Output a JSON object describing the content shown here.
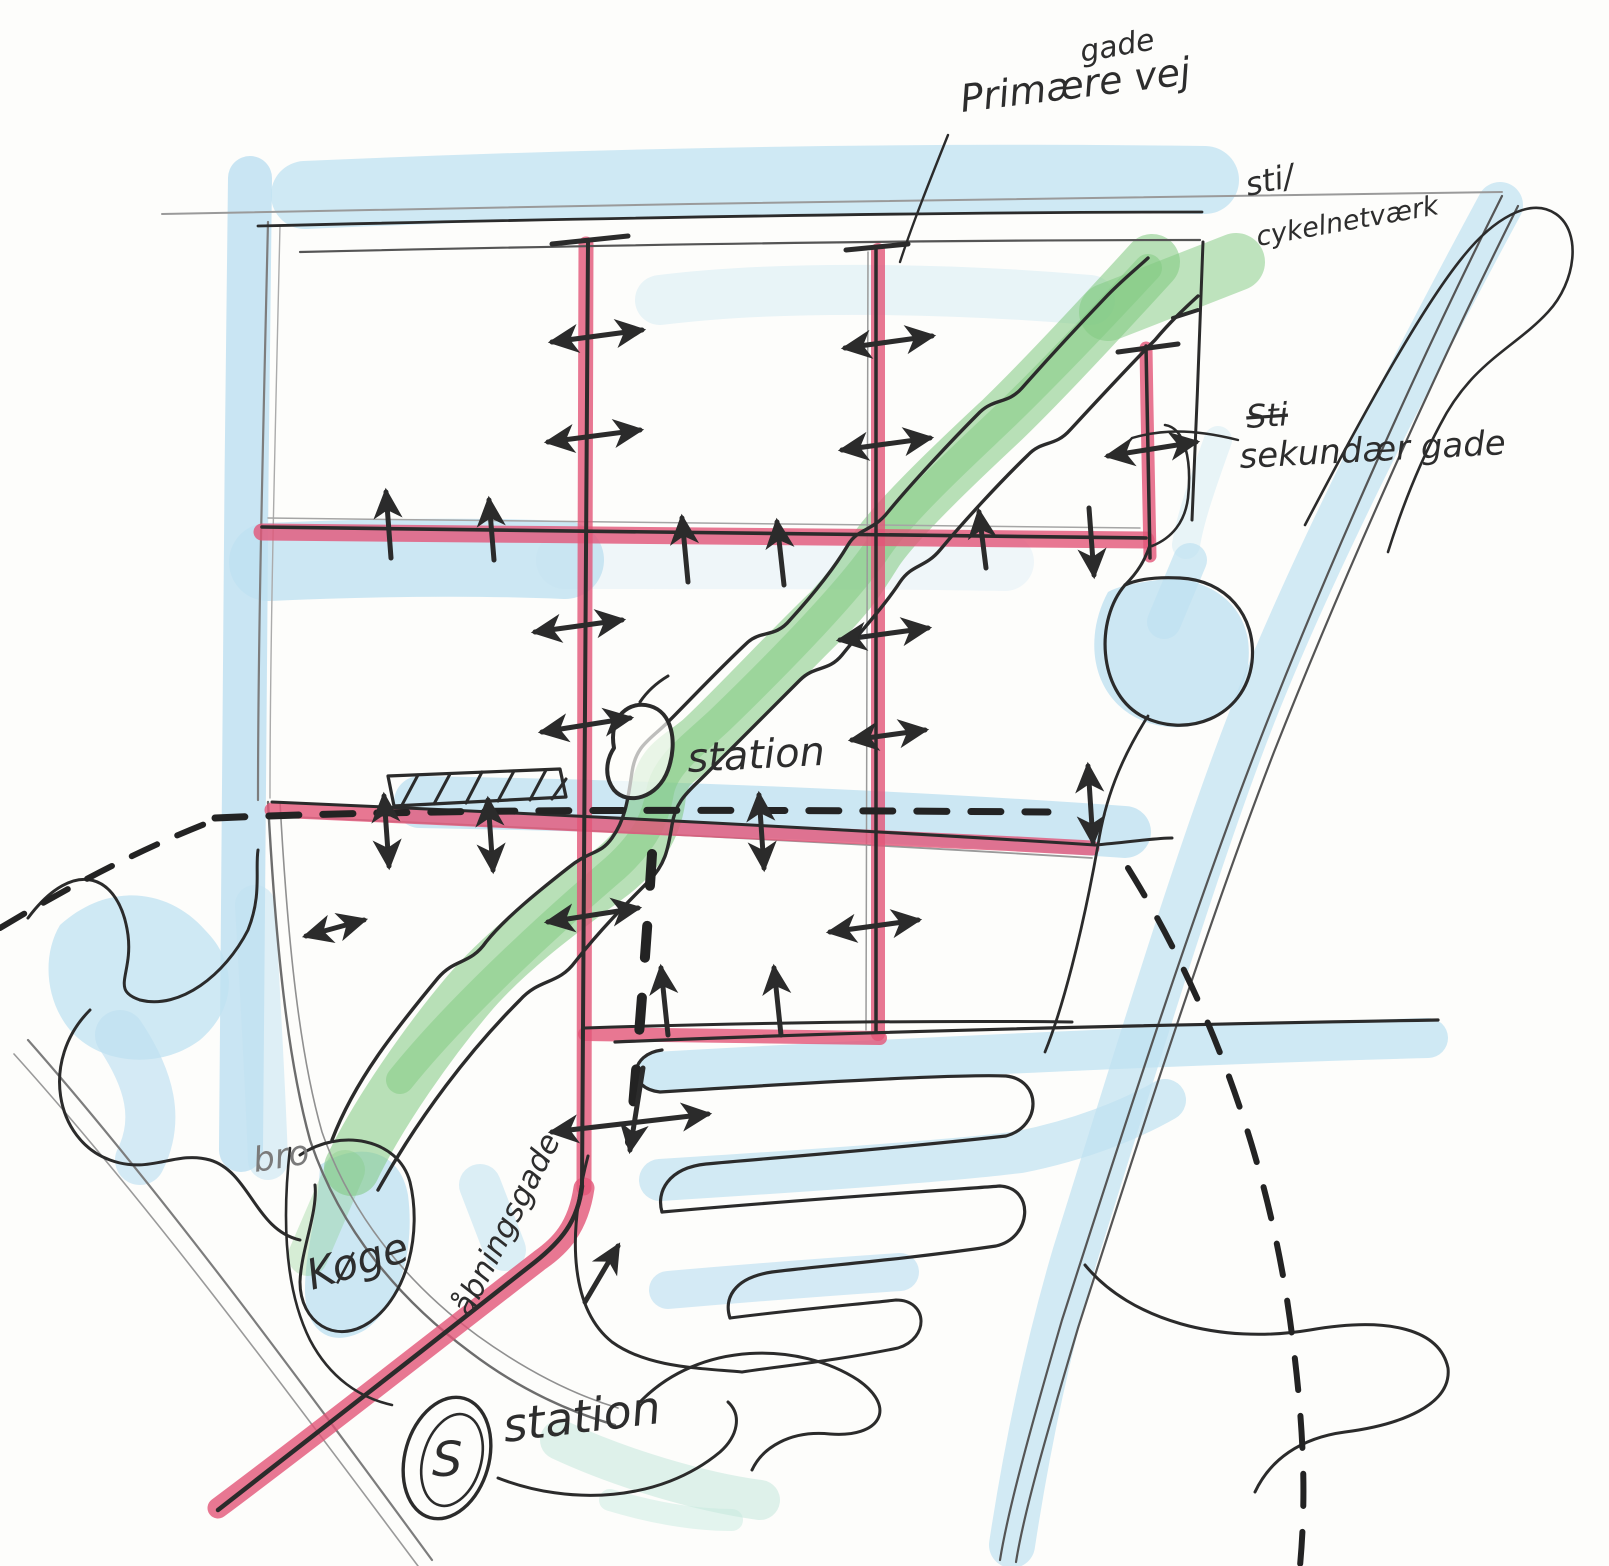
{
  "sketch": {
    "title": "hand-drawn urban plan concept sketch",
    "annotations": {
      "insert_word": "gade",
      "primary": "Primære vej",
      "bike1": "sti/",
      "bike2": "cykelnetværk",
      "sec_struck": "Sti",
      "secondary": "sekundær gade",
      "station_mid": "station",
      "bro": "bro",
      "koge": "Køge",
      "harbour": "åbningsgade",
      "s_badge": "S",
      "station_bottom": "station"
    },
    "colors": {
      "street_pink": "#e25578",
      "green_corridor": "#7fc97f",
      "water_blue": "#bfe1f1",
      "teal_wash": "#c4e8dd",
      "pen": "#2b2b2b",
      "pencil": "#8b8b8b"
    }
  }
}
